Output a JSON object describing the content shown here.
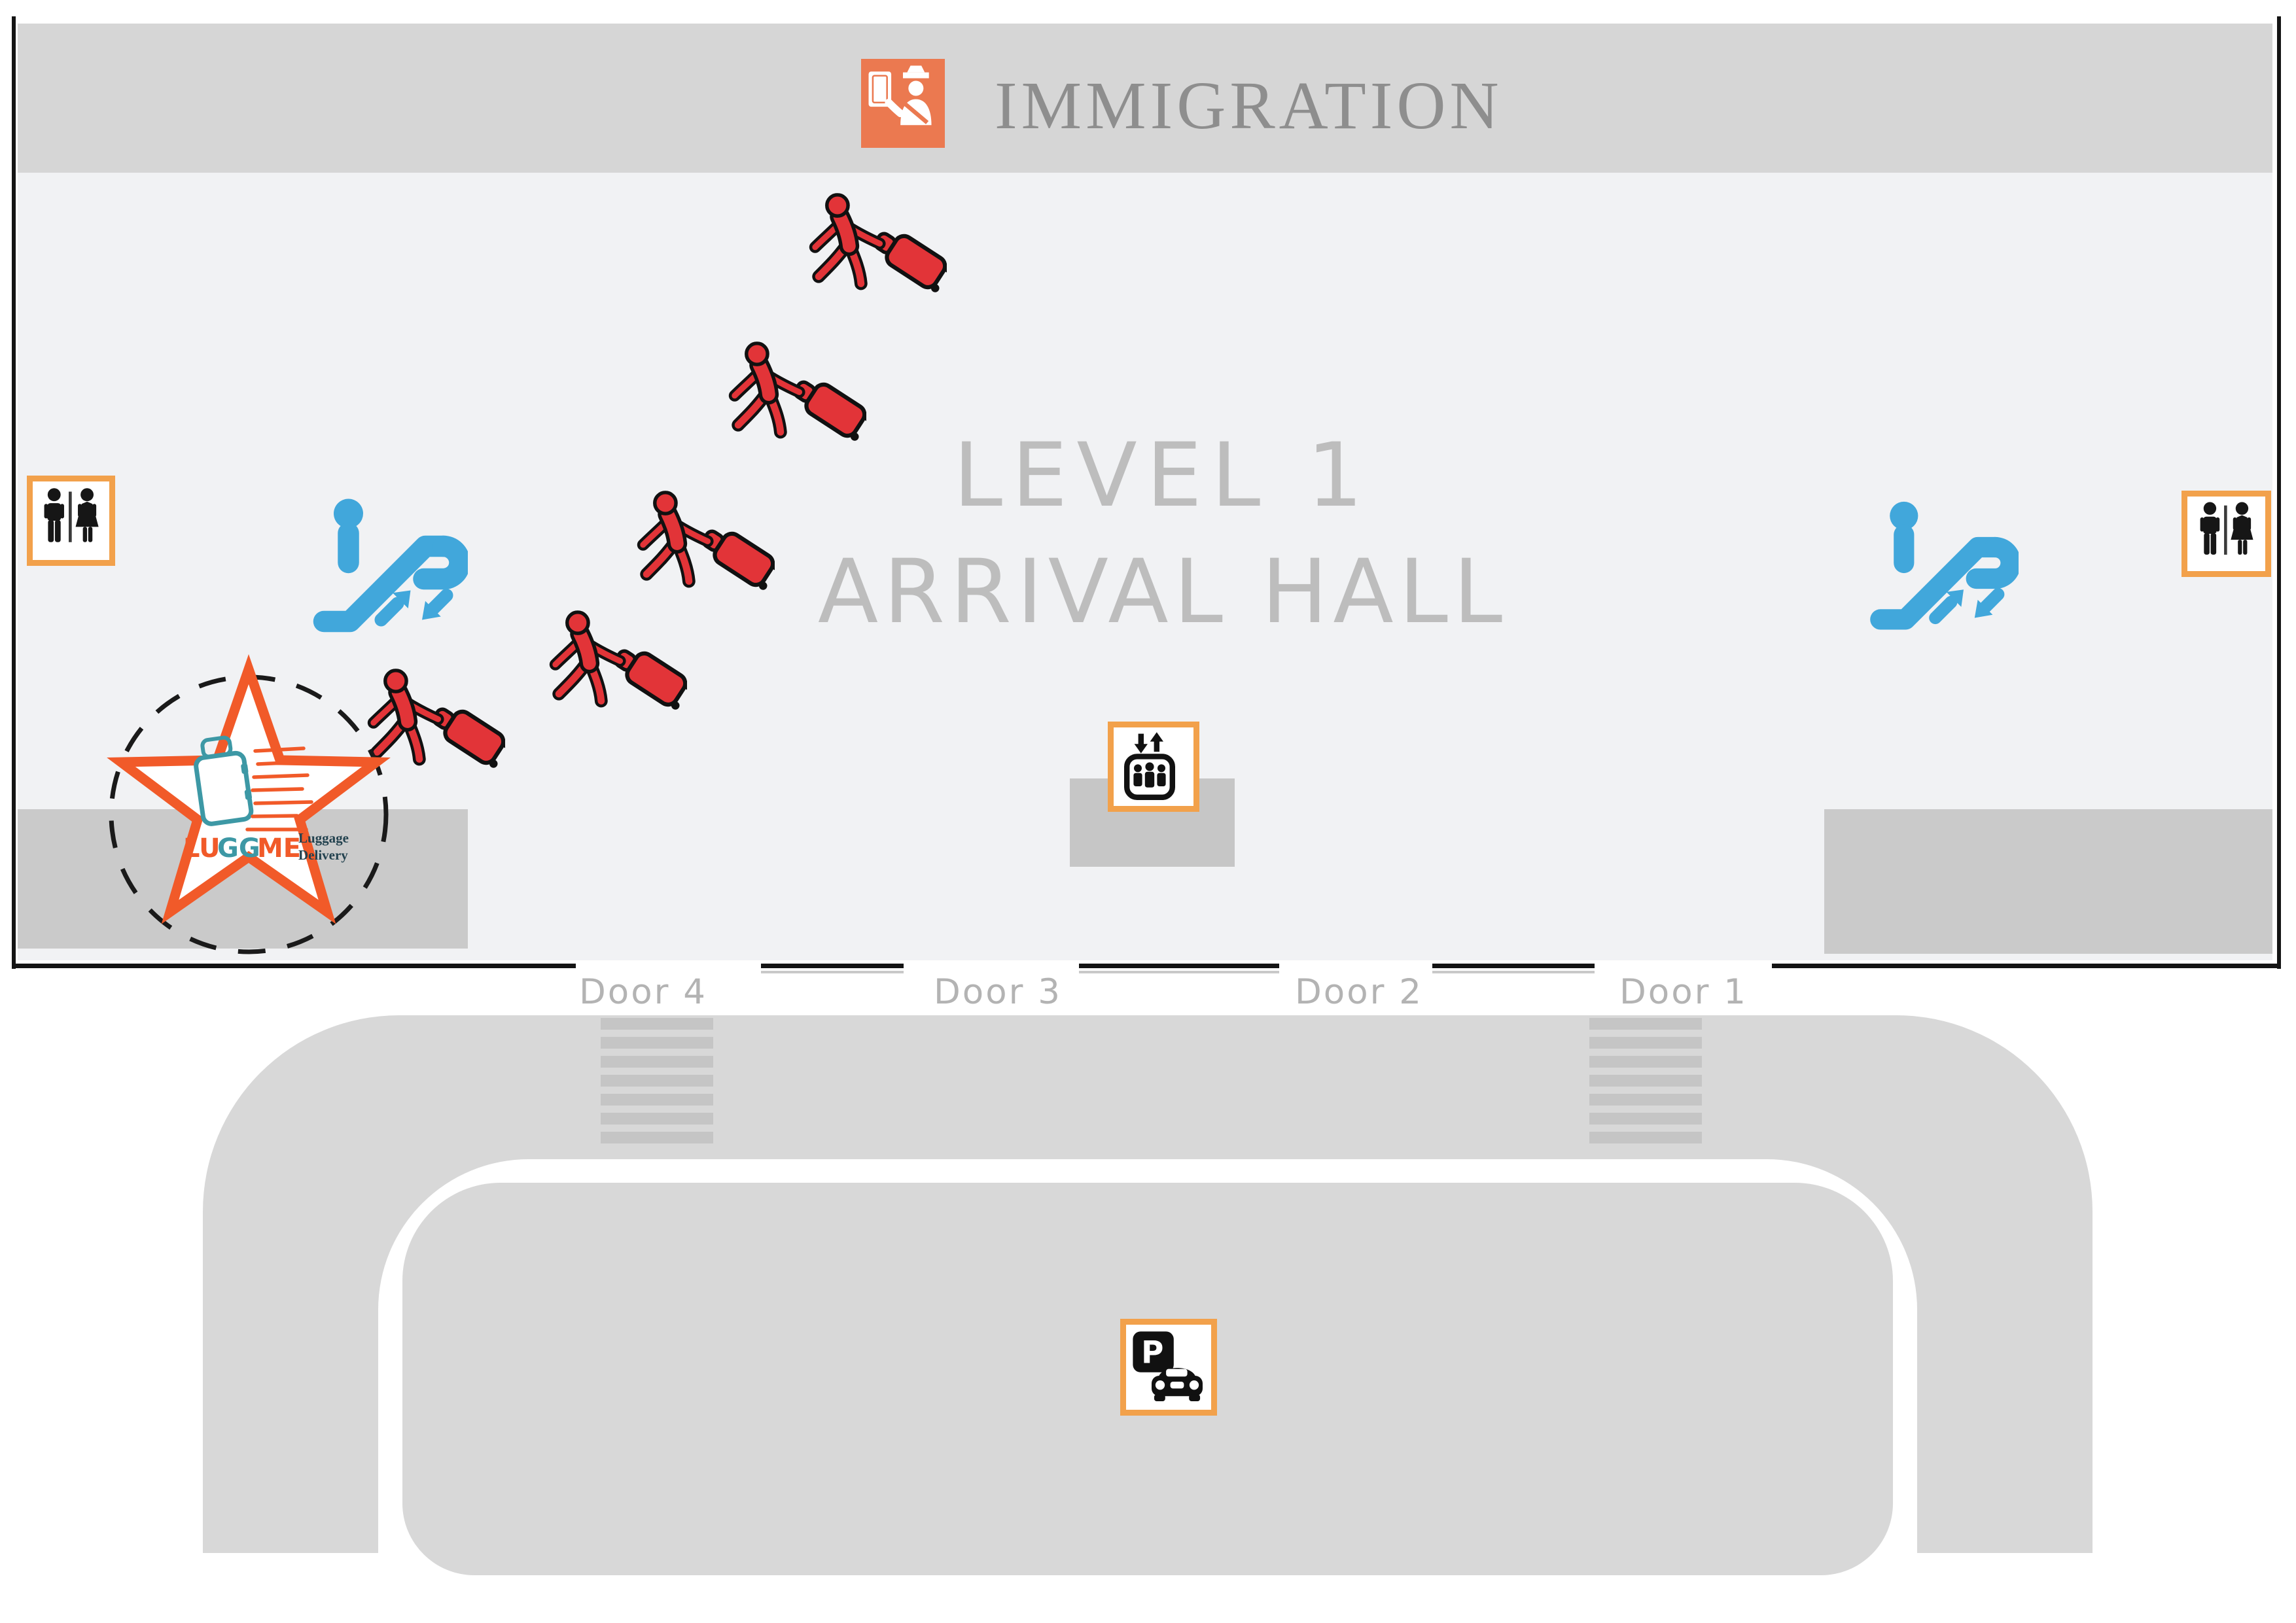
{
  "banner": {
    "title": "IMMIGRATION",
    "bg_color": "#d6d6d6",
    "icon_color": "#eb7950",
    "text_color": "#8e8e8e"
  },
  "hall": {
    "title_line1": "LEVEL 1",
    "title_line2": "ARRIVAL HALL",
    "floor_color": "#f1f2f4",
    "title_color": "#bdbdbd"
  },
  "doors": [
    {
      "label": "Door 4"
    },
    {
      "label": "Door 3"
    },
    {
      "label": "Door 2"
    },
    {
      "label": "Door 1"
    }
  ],
  "logo": {
    "word_lu": "LU",
    "word_gg": "GG",
    "word_me": "ME",
    "tagline_line1": "Luggage",
    "tagline_line2": "Delivery",
    "star_color": "#f15a29",
    "suitcase_color": "#3d98a5",
    "tagline_color": "#23424f"
  },
  "icons": {
    "parking_letter": "P",
    "sign_border_color": "#f2a14b",
    "escalator_color": "#41a7db",
    "passenger_color": "#e23438",
    "immigration_icon": "immigration-officer",
    "restroom_icon": "male-female-restroom",
    "escalator_icon": "escalator-up-down",
    "elevator_icon": "elevator",
    "parking_icon": "parking-car-pickup"
  },
  "figures": {
    "count": 5,
    "description": "red passengers walking with rolling luggage"
  }
}
